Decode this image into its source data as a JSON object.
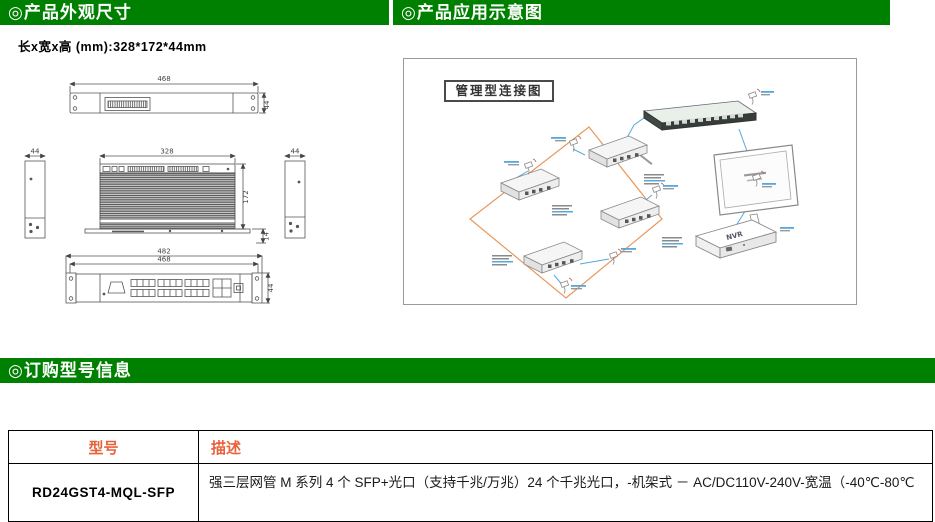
{
  "colors": {
    "header_green": "#008000",
    "header_text": "#ffffff",
    "table_header_text": "#E8623A",
    "ring_orange": "#E8975C",
    "cable_blue": "#55A8DC"
  },
  "sections": {
    "appearance": {
      "title": "◎产品外观尺寸",
      "size_note": "长x宽x高 (mm):328*172*44mm"
    },
    "application": {
      "title": "◎产品应用示意图",
      "diagram_title": "管理型连接图",
      "nvr_label": "NVR"
    },
    "ordering": {
      "title": "◎订购型号信息"
    }
  },
  "drawings": {
    "rear_view": {
      "width_dim": "468",
      "height_dim": "44"
    },
    "side_left": {
      "width_dim": "44"
    },
    "side_right": {
      "width_dim": "44"
    },
    "top_view": {
      "width_dim": "328",
      "depth_dim": "172",
      "offset_dim": "14"
    },
    "front_view": {
      "outer_dim": "482",
      "inner_dim": "468",
      "height_dim": "44"
    }
  },
  "table": {
    "headers": [
      "型号",
      "描述"
    ],
    "rows": [
      {
        "model": "RD24GST4-MQL-SFP",
        "description": "强三层网管 M 系列 4 个 SFP+光口（支持千兆/万兆）24 个千兆光口，-机架式 － AC/DC110V-240V-宽温（-40℃-80℃"
      }
    ]
  }
}
